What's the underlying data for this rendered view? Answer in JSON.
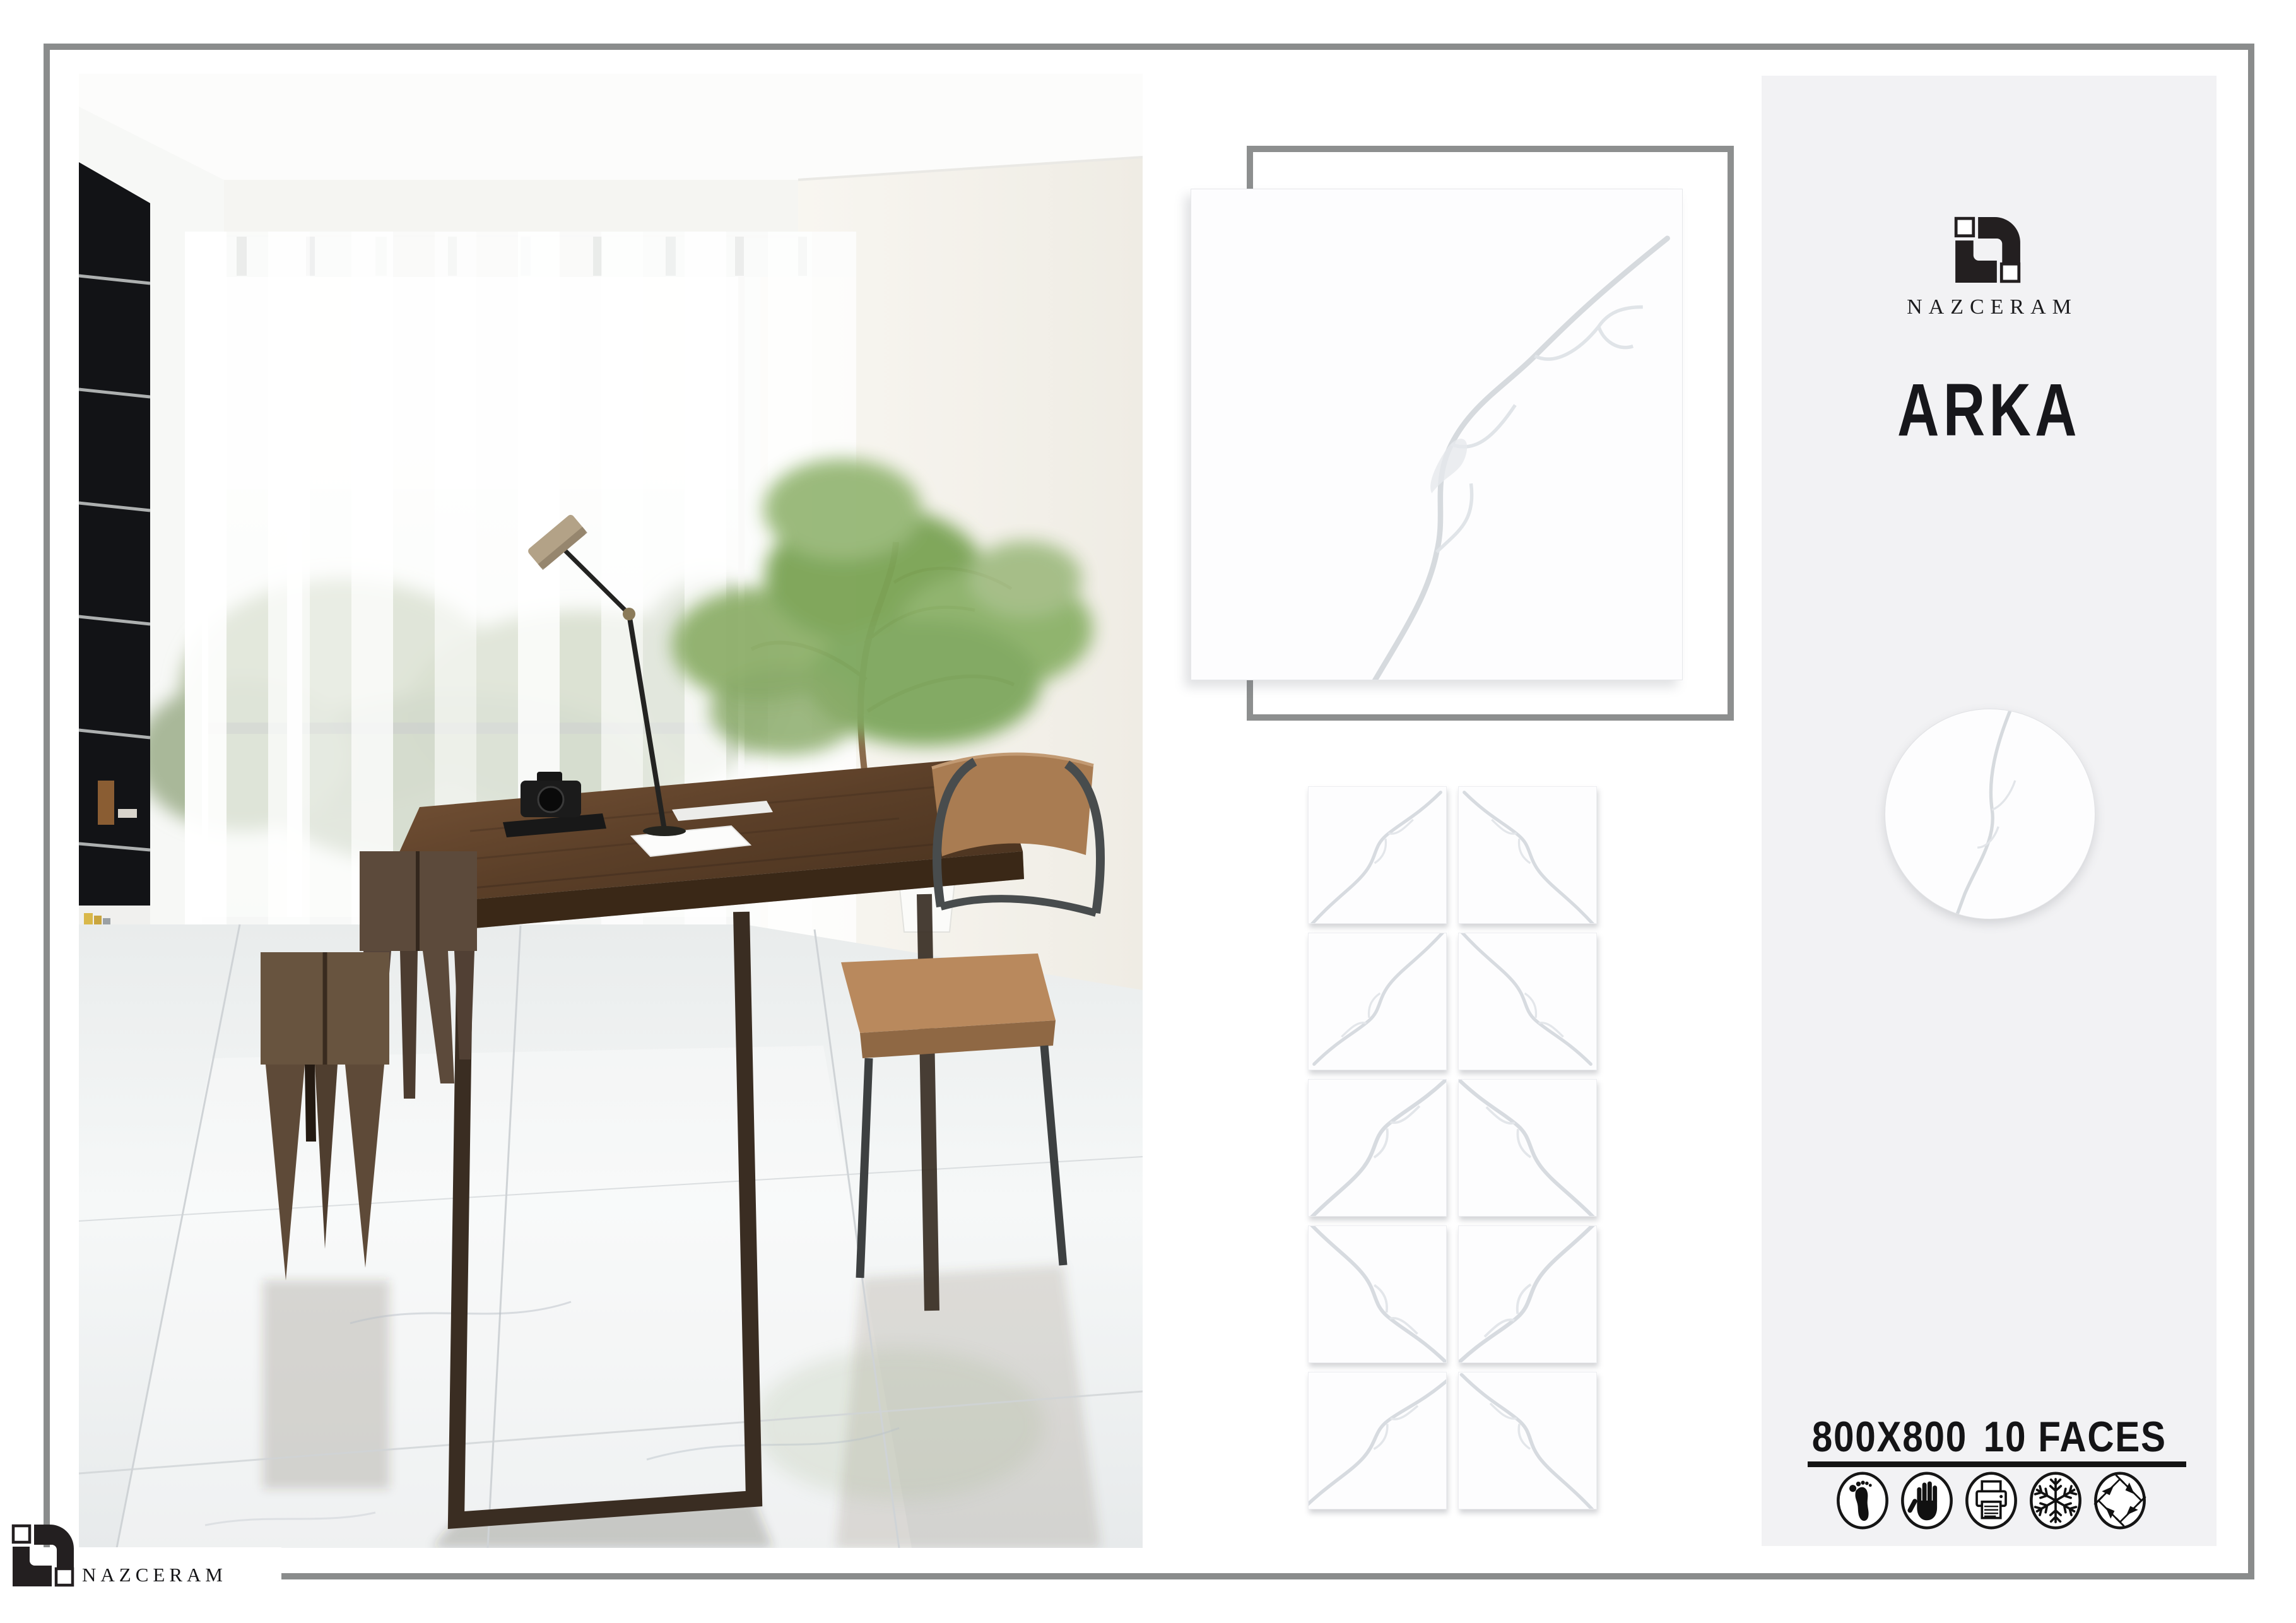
{
  "brand": {
    "name": "NAZCERAM"
  },
  "product": {
    "name": "ARKA",
    "size": "800X800",
    "faces_label": "10 FACES"
  },
  "panel": {
    "icons": [
      "foot-traffic-icon",
      "hand-icon",
      "digital-print-icon",
      "frost-resistant-icon",
      "shade-variation-icon"
    ]
  },
  "tile_grid": {
    "columns": 2,
    "rows": 5,
    "faces": 10
  },
  "colors": {
    "page_border": "#8a8c8c",
    "tile_frame": "#8d8f8f",
    "panel_bg": "#f2f2f4",
    "text": "#17171b",
    "tile_vein": "#d7dbe0",
    "logo_black": "#231f20"
  }
}
